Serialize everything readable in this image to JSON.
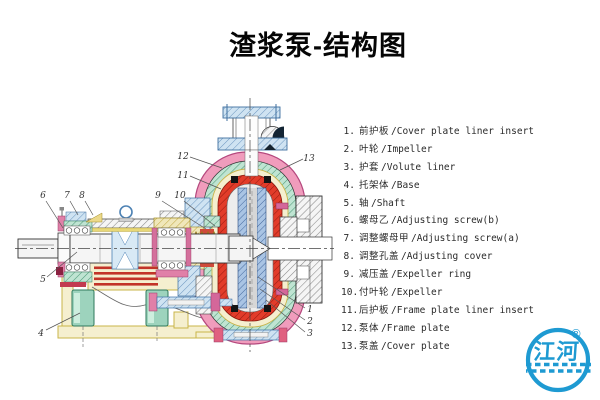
{
  "title": "渣浆泵-结构图",
  "parts_list": {
    "items": [
      {
        "num": "1.",
        "zh": "前护板",
        "en": "/Cover plate liner insert"
      },
      {
        "num": "2.",
        "zh": "叶轮",
        "en": "/Impeller"
      },
      {
        "num": "3.",
        "zh": "护套",
        "en": "/Volute liner"
      },
      {
        "num": "4.",
        "zh": "托架体",
        "en": "/Base"
      },
      {
        "num": "5.",
        "zh": "轴",
        "en": "/Shaft"
      },
      {
        "num": "6.",
        "zh": "螺母乙",
        "en": "/Adjusting screw(b)"
      },
      {
        "num": "7.",
        "zh": "调整螺母甲",
        "en": "/Adjusting screw(a)"
      },
      {
        "num": "8.",
        "zh": "调整孔盖",
        "en": "/Adjusting cover"
      },
      {
        "num": "9.",
        "zh": "减压盖",
        "en": "/Expeller ring"
      },
      {
        "num": "10.",
        "zh": "付叶轮",
        "en": "/Expeller"
      },
      {
        "num": "11.",
        "zh": "后护板",
        "en": "/Frame plate liner insert"
      },
      {
        "num": "12.",
        "zh": "泵体",
        "en": "/Frame plate"
      },
      {
        "num": "13.",
        "zh": "泵盖",
        "en": "/Cover plate"
      }
    ]
  },
  "diagram": {
    "callouts": [
      {
        "label": "1"
      },
      {
        "label": "2"
      },
      {
        "label": "3"
      },
      {
        "label": "4"
      },
      {
        "label": "5"
      },
      {
        "label": "6"
      },
      {
        "label": "7"
      },
      {
        "label": "8"
      },
      {
        "label": "9"
      },
      {
        "label": "10"
      },
      {
        "label": "11"
      },
      {
        "label": "12"
      },
      {
        "label": "13"
      }
    ]
  },
  "logo": {
    "text": "江河",
    "registered": "®"
  },
  "colors": {
    "logo_blue": "#1e9ad2",
    "casing_pink": "#f09cbc",
    "liner_red": "#e23c2a",
    "impeller_blue": "#a9c4e4",
    "frame_yellow": "#f5efcf",
    "bearing_teal": "#bfe4d2",
    "flange_blue": "#cfe3f2",
    "text": "#1a1a1a"
  }
}
